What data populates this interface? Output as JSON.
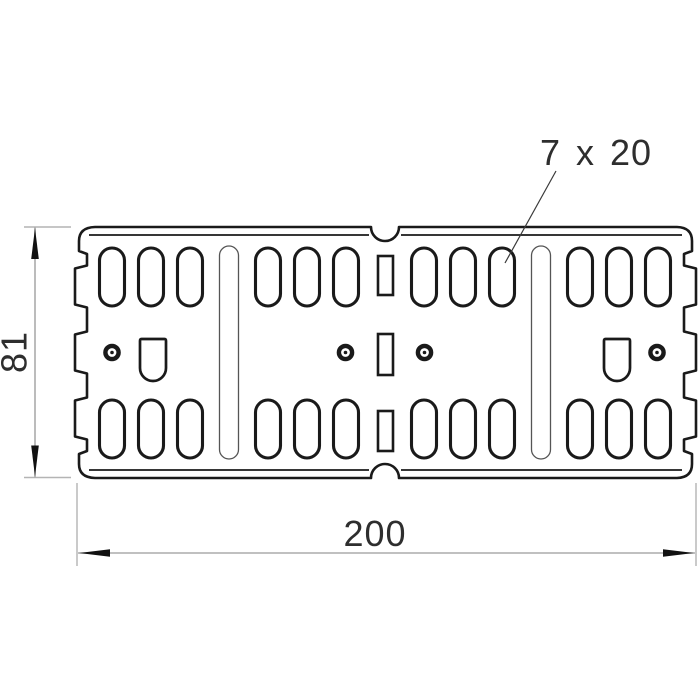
{
  "drawing": {
    "labels": {
      "height": "81",
      "width": "200",
      "slot_size": "7 x 20"
    },
    "colors": {
      "line": "#1a1a1a",
      "dimension_line": "#ababab",
      "arrow": "#111111",
      "text": "#2e2e2e",
      "background": "#ffffff"
    }
  }
}
